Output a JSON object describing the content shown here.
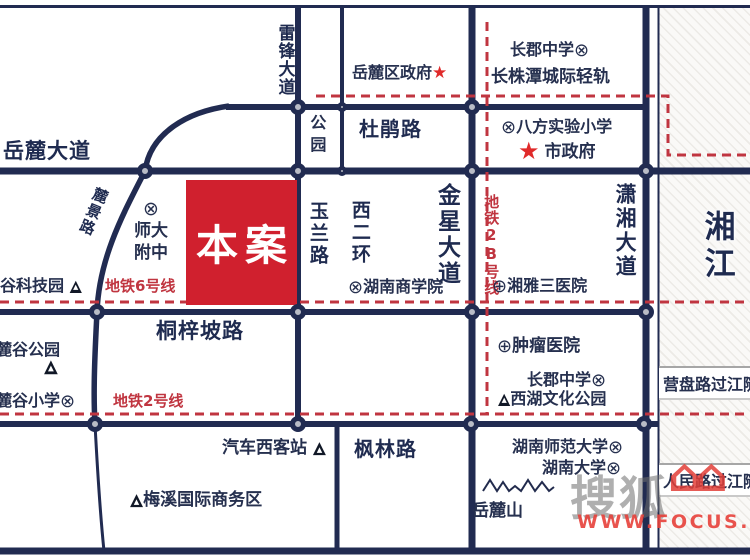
{
  "project": {
    "label": "本案"
  },
  "icons": {
    "school": "⊗",
    "hospital": "⊕",
    "star": "★",
    "landmark": "▲",
    "house": "⌂⌂"
  },
  "roads": {
    "yuelu_avenue": "岳麓大道",
    "dujuan_road": "杜鹃路",
    "tongzipo_road": "桐梓坡路",
    "fenglin_road": "枫林路",
    "leifeng_avenue": "雷锋大道",
    "park_gap": "公园",
    "yulan_road": "玉兰路",
    "west_second_ring": "西二环",
    "jinxing_avenue": "金星大道",
    "xiaoxiang_avenue": "潇湘大道",
    "lujing_road": "麓景路",
    "yingpan_tunnel": "营盘路过江隧道",
    "renmin_tunnel": "人民路过江隧道"
  },
  "river": {
    "name": "湘江"
  },
  "metro": {
    "line6": "地铁6号线",
    "line2": "地铁2号线",
    "line2b": "地铁2B号线",
    "lightrail": "长株潭城际轻轨"
  },
  "pois": {
    "yuelu_district_gov": "岳麓区政府",
    "changjun_middle_north": "长郡中学",
    "bafang_primary": "八方实验小学",
    "city_gov": "市政府",
    "shida_line1": "师大",
    "shida_line2": "附中",
    "hunan_business_college": "湖南商学院",
    "xiangya3_hospital": "湘雅三医院",
    "tech_park": "谷科技园",
    "tumor_hospital": "肿瘤医院",
    "changjun_middle_south": "长郡中学",
    "xihu_culture_park": "西湖文化公园",
    "lugu_park": "麓谷公园",
    "lugu_primary": "麓谷小学",
    "bus_west_station": "汽车西客站",
    "hunan_normal_univ": "湖南师范大学",
    "hunan_univ": "湖南大学",
    "yuelu_mountain": "岳麓山",
    "meixi_biz": "梅溪国际商务区"
  },
  "watermark": {
    "logo": "搜狐",
    "url": "WWW.FOCUS.CN"
  },
  "colors": {
    "road_navy": "#212b51",
    "metro_red": "#c03540",
    "project_red": "#d0202e",
    "node_gray": "#b9bcc6"
  }
}
